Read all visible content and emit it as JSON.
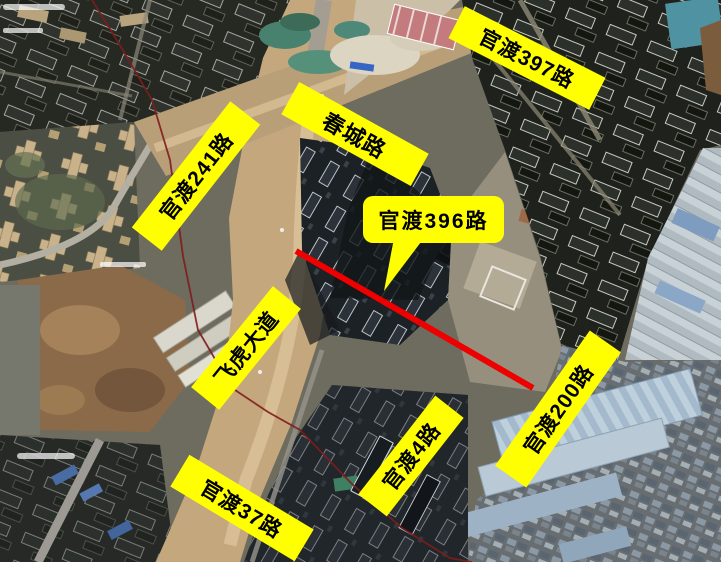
{
  "map": {
    "kind": "satellite-annotated",
    "annotation_background": "#ffff00",
    "annotation_text_color": "#000000",
    "route_line_color": "#ee0000",
    "labels": [
      {
        "id": "guandu-397-road",
        "text": "官渡397路"
      },
      {
        "id": "chuncheng-road",
        "text": "春城路"
      },
      {
        "id": "guandu-241-road",
        "text": "官渡241路"
      },
      {
        "id": "guandu-396-road",
        "text": "官渡396路"
      },
      {
        "id": "feihu-avenue",
        "text": "飞虎大道"
      },
      {
        "id": "guandu-4-road",
        "text": "官渡4路"
      },
      {
        "id": "guandu-37-road",
        "text": "官渡37路"
      },
      {
        "id": "guandu-200-road",
        "text": "官渡200路"
      }
    ]
  }
}
